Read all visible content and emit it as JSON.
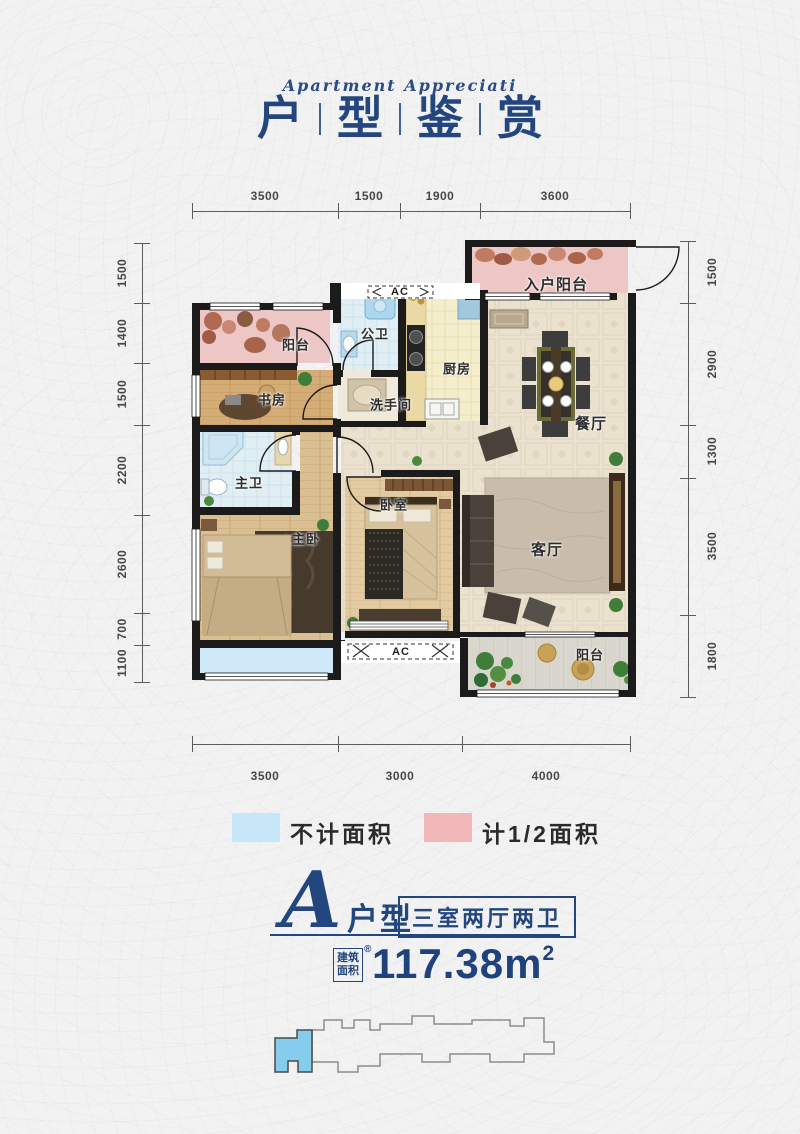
{
  "header": {
    "subtitle": "Apartment Appreciati",
    "title_chars": [
      "户",
      "型",
      "鉴",
      "赏"
    ]
  },
  "dims": {
    "top": [
      "3500",
      "1500",
      "1900",
      "3600"
    ],
    "bottom": [
      "3500",
      "3000",
      "4000"
    ],
    "left": [
      "1500",
      "1400",
      "1500",
      "2200",
      "2600",
      "700",
      "1100"
    ],
    "right": [
      "1500",
      "2900",
      "1300",
      "3500",
      "1800"
    ]
  },
  "rooms": {
    "entry_balcony": "入户阳台",
    "balcony_top": "阳台",
    "public_bath": "公卫",
    "kitchen": "厨房",
    "study": "书房",
    "washroom": "洗手间",
    "dining": "餐厅",
    "master_bath": "主卫",
    "bedroom": "卧室",
    "master_bedroom": "主卧",
    "living": "客厅",
    "balcony_bottom": "阳台",
    "ac_top": "AC",
    "ac_bottom": "AC"
  },
  "legend": {
    "not_counted": {
      "label": "不计面积",
      "color": "#c7e6f7"
    },
    "half_counted": {
      "label": "计1/2面积",
      "color": "#f2b7b9"
    }
  },
  "unit": {
    "letter": "A",
    "type_label": "户型",
    "layout_label": "三室两厅两卫",
    "area_box_line1": "建筑",
    "area_box_line2": "面积",
    "reg_mark": "®",
    "area_number": "117.38m",
    "area_sup": "2"
  },
  "colors": {
    "navy": "#24467e",
    "wall": "#1b1b1b",
    "legend_blue": "#c7e6f7",
    "legend_pink": "#f2b7b9",
    "balcony_pink": "#edc6c6",
    "bay_blue": "#cfe9f8",
    "unit_highlight": "#86ccec"
  }
}
